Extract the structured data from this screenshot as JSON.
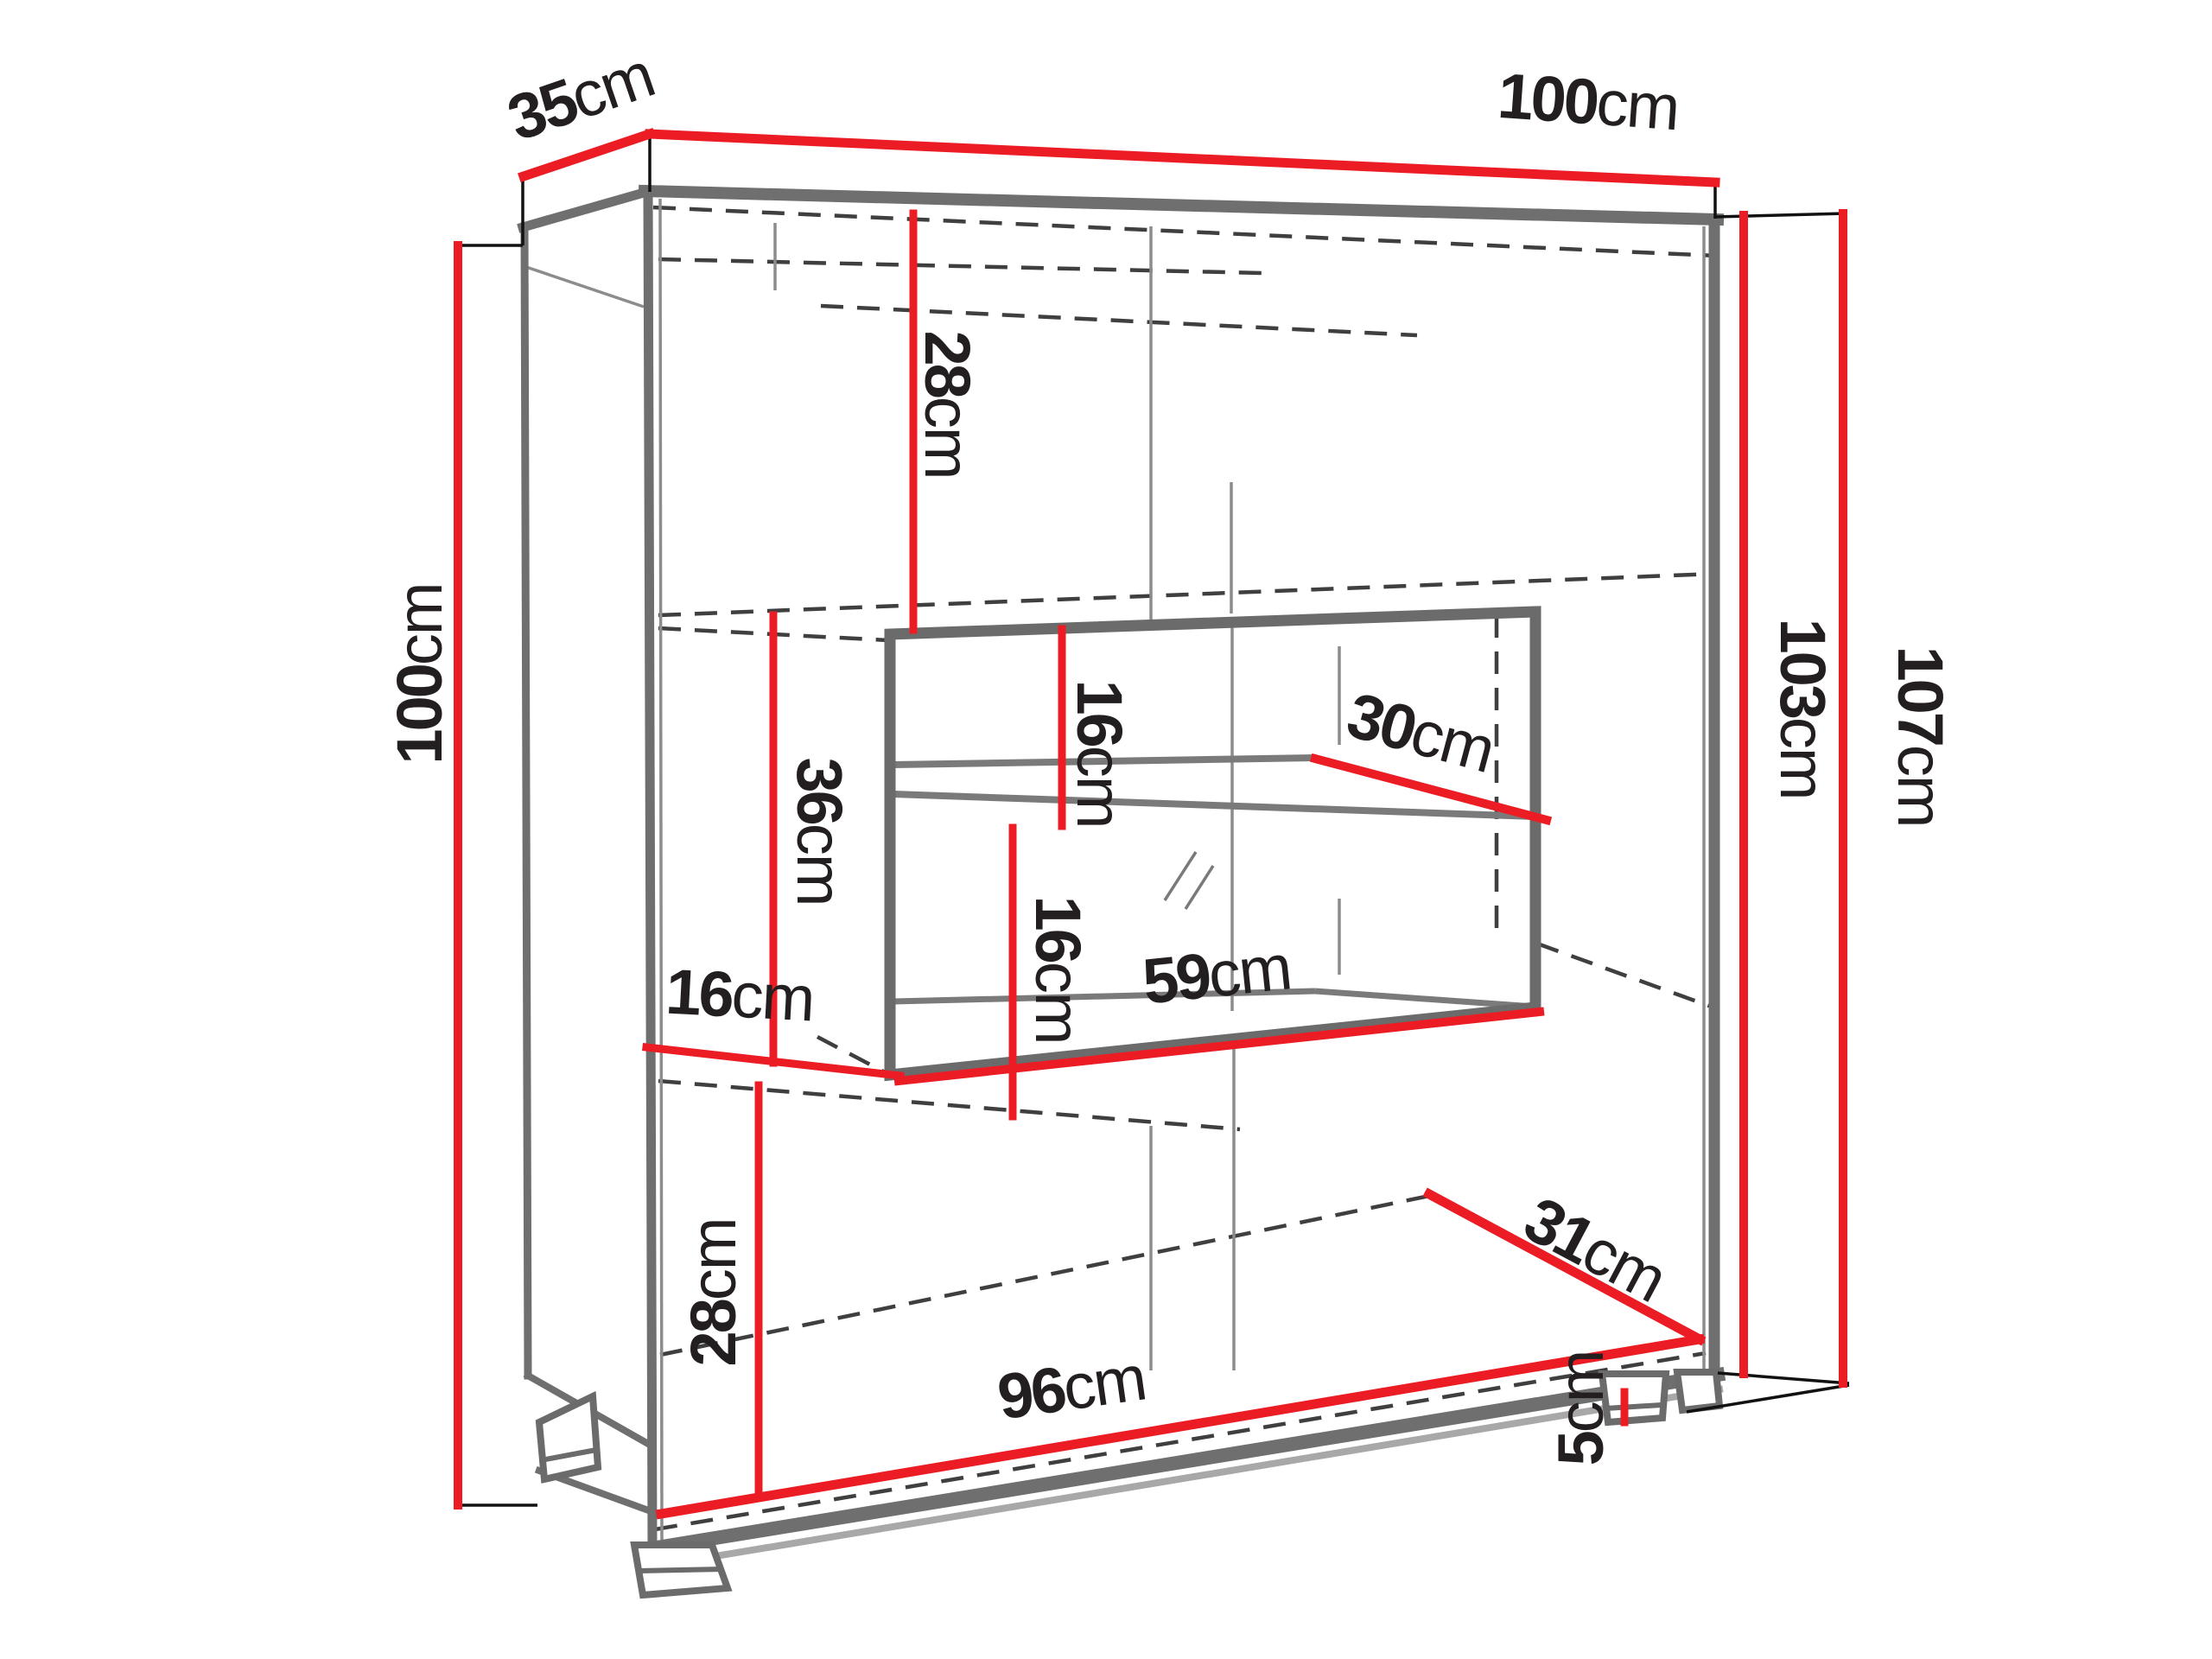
{
  "page": {
    "background": "#ffffff"
  },
  "diagram": {
    "name": "cabinet-dimension-diagram",
    "unit": "cm",
    "colors": {
      "dimension_line": "#ec1c24",
      "edge_gray": "#6f6f6f",
      "hidden_edge": "#3f3f3f",
      "text": "#231f20",
      "background": "#ffffff"
    },
    "dimensions": {
      "depth_top": {
        "value": "35",
        "unit": "cm"
      },
      "width_top": {
        "value": "100",
        "unit": "cm"
      },
      "height_left": {
        "value": "100",
        "unit": "cm"
      },
      "upper_compartment_height": {
        "value": "28",
        "unit": "cm"
      },
      "niche_upper_gap": {
        "value": "16",
        "unit": "cm"
      },
      "shelf_depth": {
        "value": "30",
        "unit": "cm"
      },
      "middle_compartment_height": {
        "value": "36",
        "unit": "cm"
      },
      "niche_lower_gap": {
        "value": "16",
        "unit": "cm"
      },
      "niche_width": {
        "value": "59",
        "unit": "cm"
      },
      "side_gap": {
        "value": "16",
        "unit": "cm"
      },
      "bottom_compartment_height": {
        "value": "28",
        "unit": "cm"
      },
      "bottom_width": {
        "value": "96",
        "unit": "cm"
      },
      "bottom_depth": {
        "value": "31",
        "unit": "cm"
      },
      "foot_height": {
        "value": "5",
        "unit": "cm"
      },
      "carcass_height_right": {
        "value": "103",
        "unit": "cm"
      },
      "total_height_right": {
        "value": "107",
        "unit": "cm"
      }
    }
  }
}
